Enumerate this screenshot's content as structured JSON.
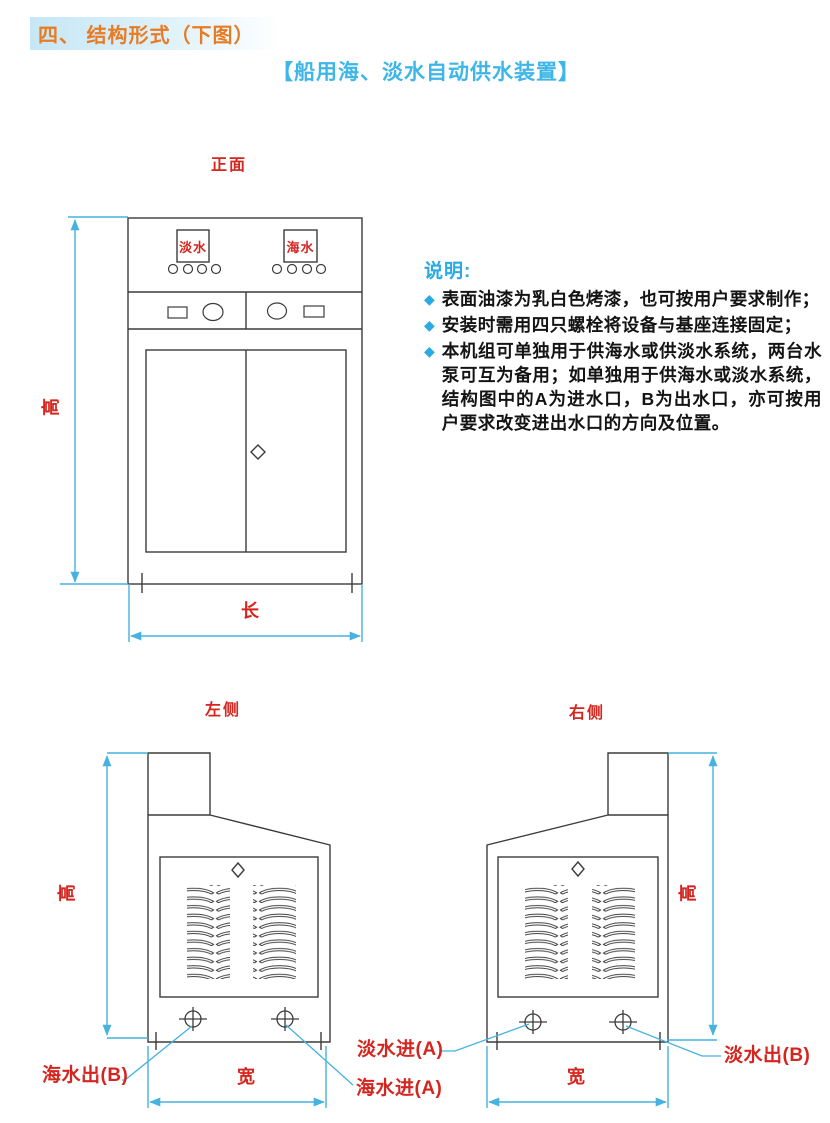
{
  "page": {
    "section_title": "四、 结构形式（下图）",
    "subtitle": "【船用海、淡水自动供水装置】"
  },
  "notes": {
    "heading": "说明:",
    "bullet": "◆",
    "items": [
      "表面油漆为乳白色烤漆，也可按用户要求制作；",
      "安装时需用四只螺栓将设备与基座连接固定；",
      "本机组可单独用于供海水或供淡水系统，两台水泵可互为备用；如单独用于供海水或淡水系统，结构图中的A为进水口，B为出水口，亦可按用户要求改变进出水口的方向及位置。"
    ]
  },
  "front_view": {
    "title": "正面",
    "panel_left_label": "淡水",
    "panel_right_label": "海水",
    "dim_length": "长",
    "dim_height": "高"
  },
  "left_view": {
    "title": "左侧",
    "dim_width": "宽",
    "dim_height": "高"
  },
  "right_view": {
    "title": "右侧",
    "dim_width": "宽",
    "dim_height": "高"
  },
  "ports": {
    "sea_out": "海水出(B)",
    "sea_in": "海水进(A)",
    "fresh_in": "淡水进(A)",
    "fresh_out": "淡水出(B)"
  },
  "colors": {
    "accent_blue": "#29abe2",
    "dimension_blue": "#45b2e0",
    "label_red": "#d4261f",
    "header_orange": "#e87c25",
    "line_dark": "#3c3c3c"
  }
}
